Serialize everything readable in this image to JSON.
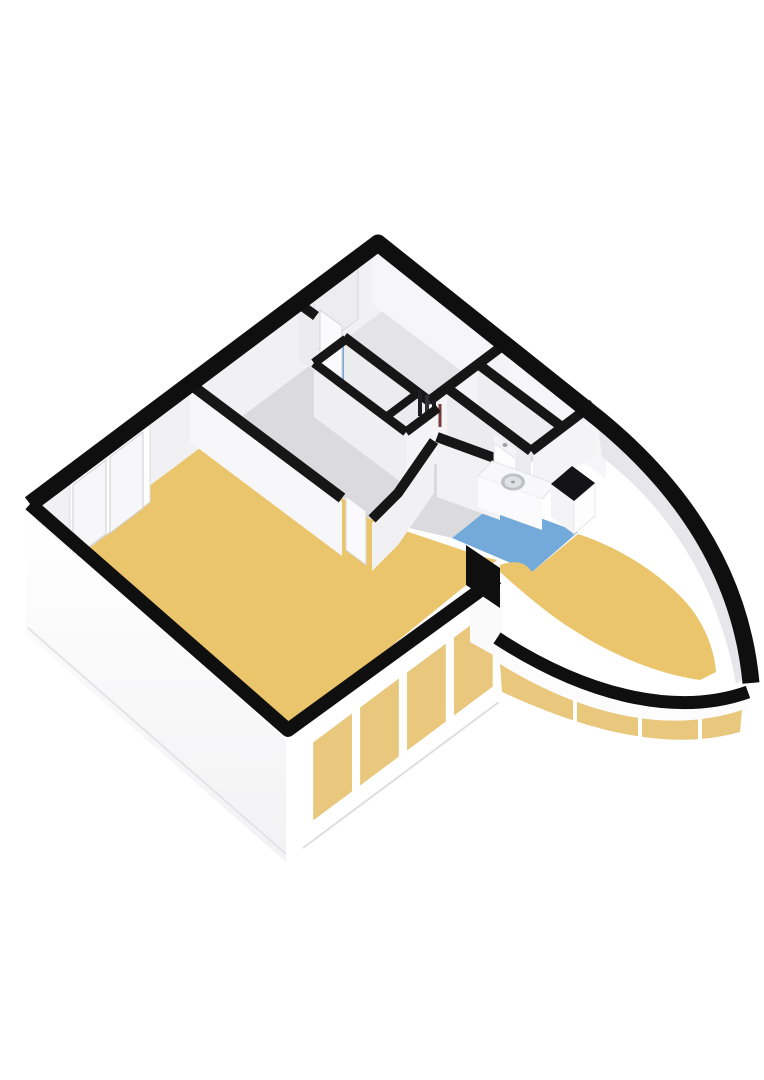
{
  "page": {
    "title": "3D floor plan",
    "background": "#ffffff"
  },
  "floorplan": {
    "title": "Isometric 3D floor plan of an apartment with a curved glass facade",
    "view": "3d-isometric",
    "colors": {
      "outline": "#0f0f0f",
      "interior_wall_top": "#161616",
      "floor_wood": "#EBC56B",
      "floor_blue": "#74AAD9",
      "floor_hall": "#DBDBDE",
      "floor_room": "#E4E4E7",
      "floor_small_room_a": "#F0F0F3",
      "floor_small_room_b": "#E9E9EC",
      "floor_closet_dark": "#26262B",
      "wall_face_light": "#F1F1F3",
      "wall_face_lit": "#F6F6F8",
      "wall_curve_shadow": "#E7E7EB",
      "glass_tint": "#E9C87E",
      "glass_pale": "#F7F7F9",
      "fixture_dark": "#141416",
      "shelf_maroon": "#7B3A3A",
      "frame_white": "#FCFCFD"
    },
    "rooms": [
      {
        "id": "living-room",
        "floor": "wood"
      },
      {
        "id": "curved-sun-room",
        "floor": "wood"
      },
      {
        "id": "kitchen",
        "floor": "blue-tile"
      },
      {
        "id": "bathroom",
        "floor": "blue-tile"
      },
      {
        "id": "hallway",
        "floor": "gray"
      },
      {
        "id": "top-room",
        "floor": "gray"
      },
      {
        "id": "storage-room-a",
        "floor": "light-gray"
      },
      {
        "id": "storage-room-b",
        "floor": "light-gray"
      },
      {
        "id": "utility-closet",
        "floor": "dark-shelving"
      }
    ],
    "fixtures": [
      "kitchen-counter",
      "round-sink",
      "cooktop",
      "washing-machine",
      "closet-shelving",
      "interior-door-top-room",
      "interior-door-living-room",
      "door-nw-wall"
    ],
    "windows": {
      "nw_wall_windows": 1,
      "glass_wall_panes": 4,
      "curved_wall_mullions": 3
    }
  }
}
